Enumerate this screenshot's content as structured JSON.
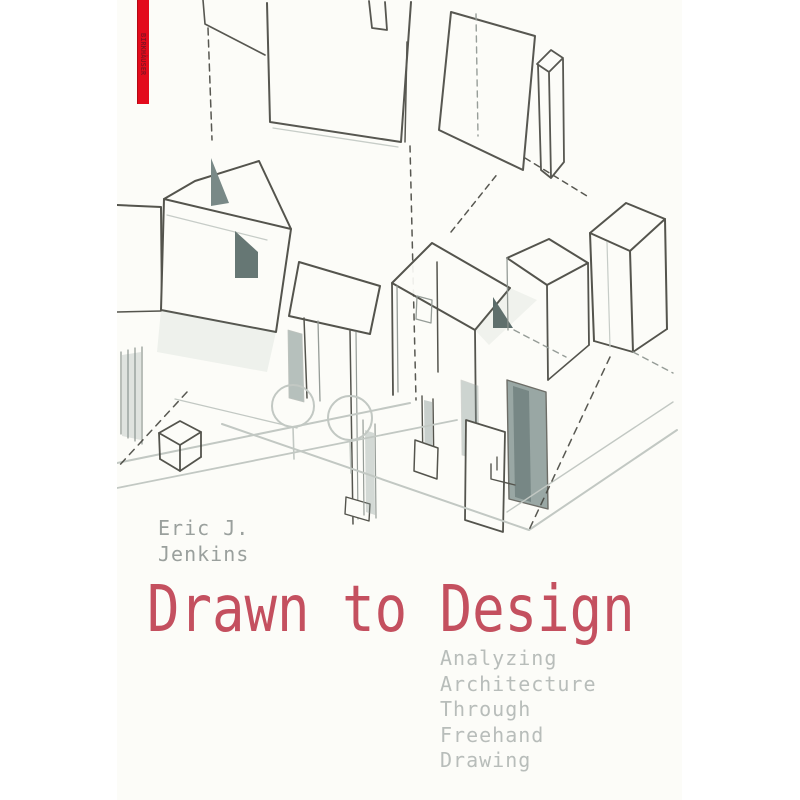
{
  "cover": {
    "publisher": {
      "name": "BIRKHÄUSER",
      "bar_color": "#e30b1c",
      "text_color": "#8e1020"
    },
    "author": {
      "line1": "Eric J.",
      "line2": "Jenkins",
      "color": "#9aa09d"
    },
    "title": {
      "text": "Drawn to Design",
      "color": "#c4505f"
    },
    "subtitle": {
      "lines": [
        "Analyzing",
        "Architecture",
        "Through",
        "Freehand",
        "Drawing"
      ],
      "color": "#b8bdba"
    },
    "illustration": {
      "description": "freehand axonometric pencil sketch of building masses, floating planes, dashed projection lines, small cube and two round trees",
      "ink_color": "#46463f",
      "mid_color": "#8d948f",
      "light_color": "#c2c8c3",
      "shade_color": "#7e908d",
      "paper_color": "#fcfcf8"
    }
  }
}
